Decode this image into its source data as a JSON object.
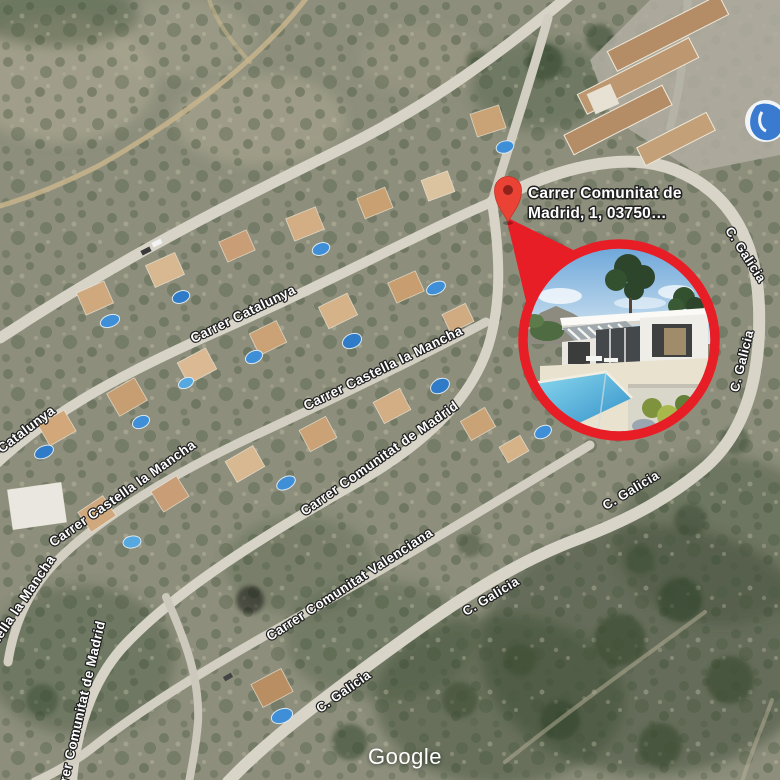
{
  "callout": {
    "line1": "Carrer Comunitat de",
    "line2": "Madrid, 1, 03750…"
  },
  "streets": [
    {
      "name": "carrer-catalunya",
      "text": "Carrer Catalunya"
    },
    {
      "name": "carrer-catalunya-west",
      "text": "Carrer Catalunya"
    },
    {
      "name": "carrer-castella-la-mancha",
      "text": "Carrer Castella la Mancha"
    },
    {
      "name": "carrer-castella-la-mancha-west",
      "text": "Carrer Castella la Mancha"
    },
    {
      "name": "castella-la-mancha-southwest",
      "text": "Castella la Mancha"
    },
    {
      "name": "carrer-comunitat-de-madrid",
      "text": "Carrer Comunitat de Madrid"
    },
    {
      "name": "carrer-comunitat-de-madrid-south",
      "text": "Carrer Comunitat de Madrid"
    },
    {
      "name": "carrer-comunitat-valenciana",
      "text": "Carrer Comunitat Valenciana"
    },
    {
      "name": "c-galicia-northeast",
      "text": "C. Galicia"
    },
    {
      "name": "c-galicia-east",
      "text": "C. Galicia"
    },
    {
      "name": "c-galicia-southeast",
      "text": "C. Galicia"
    },
    {
      "name": "c-galicia-south-upper",
      "text": "C. Galicia"
    },
    {
      "name": "c-galicia-south-lower",
      "text": "C. Galicia"
    }
  ],
  "attribution": {
    "logo_text": "Google"
  },
  "colors": {
    "pin": "#ea4335",
    "pin_inner": "#8f231c",
    "photo_ring": "#e81e26",
    "street_label": "#ffffff"
  },
  "photo": {
    "subject": "villa-with-pool-render"
  }
}
